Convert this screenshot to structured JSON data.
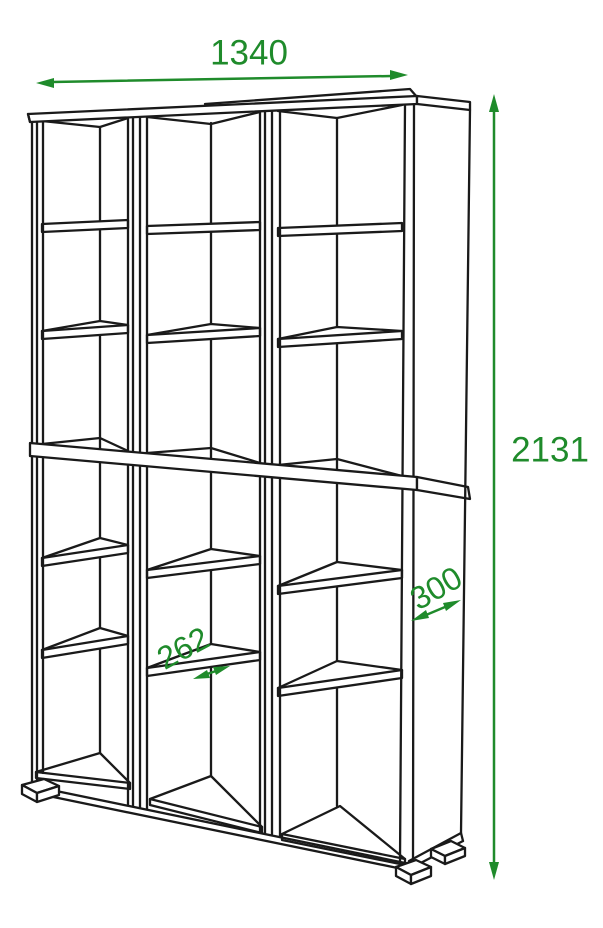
{
  "diagram": {
    "dimensions": {
      "width": "1340",
      "height": "2131",
      "depth": "300",
      "cell_width": "262"
    },
    "colors": {
      "dimension_accent": "#1f8b2b",
      "outline": "#1a1a1a",
      "background": "#ffffff"
    }
  }
}
